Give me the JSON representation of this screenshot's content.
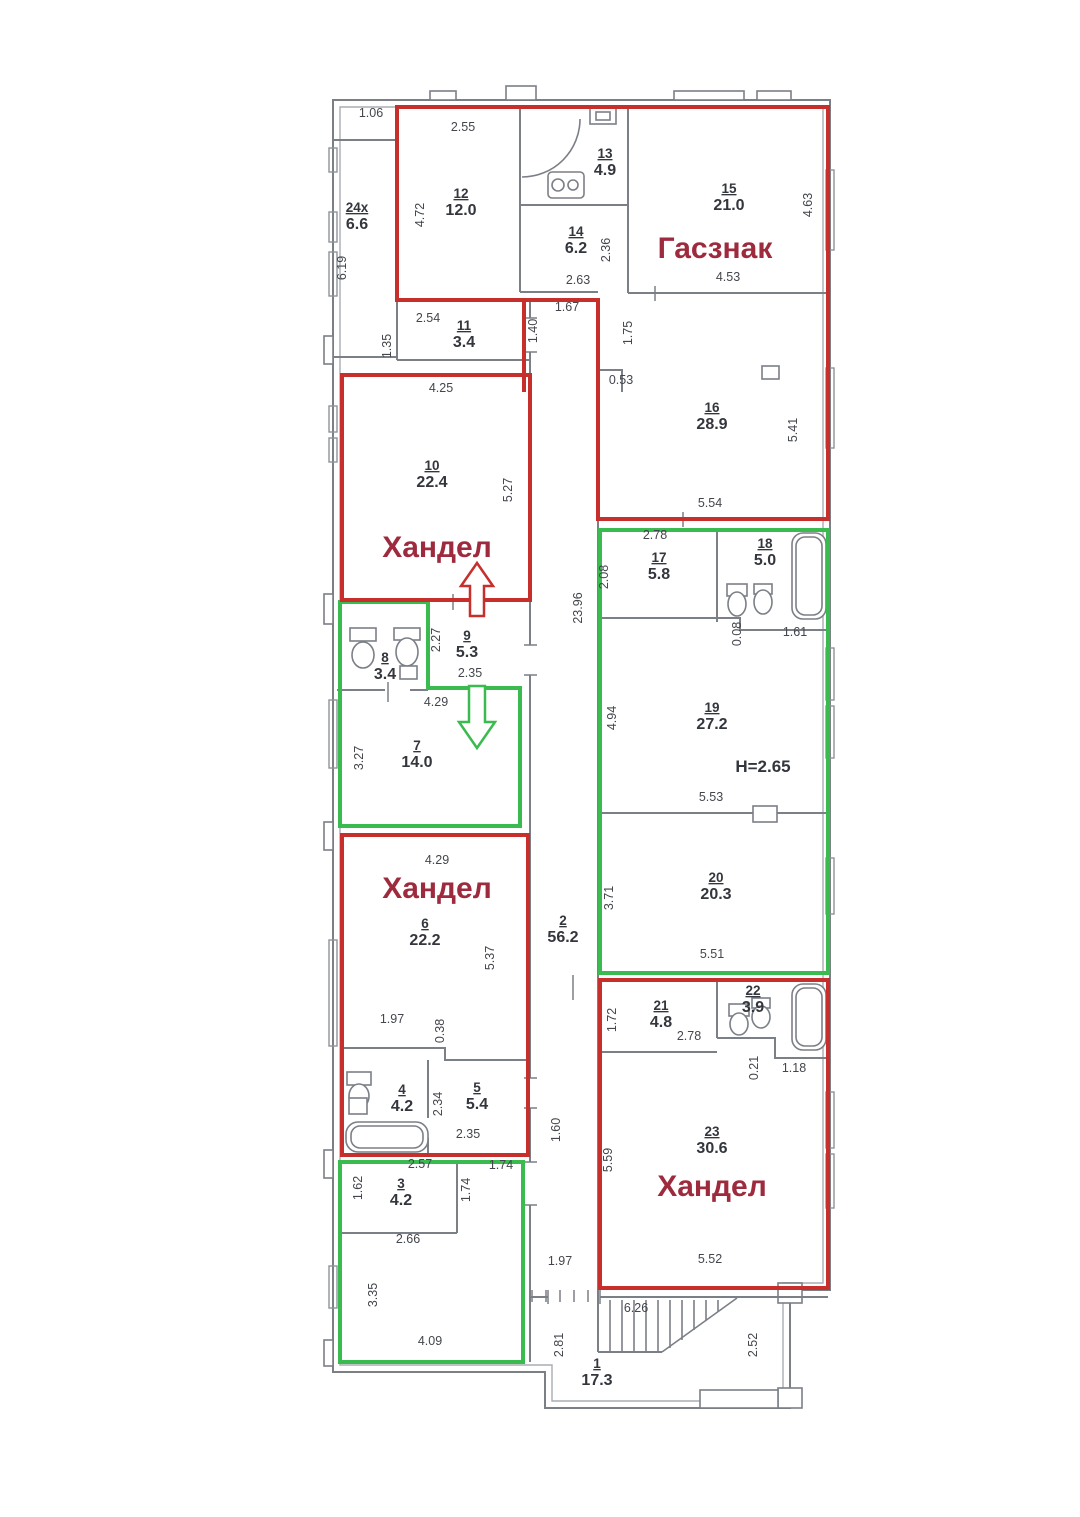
{
  "plan": {
    "colors": {
      "red_outline": "#c72f2c",
      "green_outline": "#3abb4f",
      "unit_label_red": "#9e2a3e",
      "wall_gray": "#7b7f86",
      "dim_text": "#43464c"
    },
    "unit_labels": [
      {
        "text": "Гасзнак",
        "x": 715,
        "y": 258
      },
      {
        "text": "Хандел",
        "x": 437,
        "y": 557
      },
      {
        "text": "Хандел",
        "x": 437,
        "y": 898
      },
      {
        "text": "Хандел",
        "x": 712,
        "y": 1196
      }
    ],
    "rooms": [
      {
        "num": "1",
        "area": "17.3",
        "x": 597,
        "y": 1368
      },
      {
        "num": "2",
        "area": "56.2",
        "x": 563,
        "y": 925
      },
      {
        "num": "3",
        "area": "4.2",
        "x": 401,
        "y": 1188
      },
      {
        "num": "4",
        "area": "4.2",
        "x": 402,
        "y": 1094
      },
      {
        "num": "5",
        "area": "5.4",
        "x": 477,
        "y": 1092
      },
      {
        "num": "6",
        "area": "22.2",
        "x": 425,
        "y": 928
      },
      {
        "num": "7",
        "area": "14.0",
        "x": 417,
        "y": 750
      },
      {
        "num": "8",
        "area": "3.4",
        "x": 385,
        "y": 662
      },
      {
        "num": "9",
        "area": "5.3",
        "x": 467,
        "y": 640
      },
      {
        "num": "10",
        "area": "22.4",
        "x": 432,
        "y": 470
      },
      {
        "num": "11",
        "area": "3.4",
        "x": 464,
        "y": 330
      },
      {
        "num": "12",
        "area": "12.0",
        "x": 461,
        "y": 198
      },
      {
        "num": "13",
        "area": "4.9",
        "x": 605,
        "y": 158
      },
      {
        "num": "14",
        "area": "6.2",
        "x": 576,
        "y": 236
      },
      {
        "num": "15",
        "area": "21.0",
        "x": 729,
        "y": 193
      },
      {
        "num": "16",
        "area": "28.9",
        "x": 712,
        "y": 412
      },
      {
        "num": "17",
        "area": "5.8",
        "x": 659,
        "y": 562
      },
      {
        "num": "18",
        "area": "5.0",
        "x": 765,
        "y": 548
      },
      {
        "num": "19",
        "area": "27.2",
        "x": 712,
        "y": 712
      },
      {
        "num": "20",
        "area": "20.3",
        "x": 716,
        "y": 882
      },
      {
        "num": "21",
        "area": "4.8",
        "x": 661,
        "y": 1010
      },
      {
        "num": "22",
        "area": "3.9",
        "x": 753,
        "y": 995
      },
      {
        "num": "23",
        "area": "30.6",
        "x": 712,
        "y": 1136
      },
      {
        "num": "24x",
        "area": "6.6",
        "x": 357,
        "y": 212
      }
    ],
    "dims": [
      {
        "t": "1.06",
        "x": 371,
        "y": 117,
        "r": 0
      },
      {
        "t": "6.19",
        "x": 346,
        "y": 268,
        "r": -90
      },
      {
        "t": "2.55",
        "x": 463,
        "y": 131,
        "r": 0
      },
      {
        "t": "4.72",
        "x": 424,
        "y": 215,
        "r": -90
      },
      {
        "t": "2.54",
        "x": 428,
        "y": 322,
        "r": 0
      },
      {
        "t": "1.35",
        "x": 391,
        "y": 346,
        "r": -90
      },
      {
        "t": "1.40",
        "x": 537,
        "y": 331,
        "r": -90
      },
      {
        "t": "1.67",
        "x": 567,
        "y": 311,
        "r": 0
      },
      {
        "t": "2.63",
        "x": 578,
        "y": 284,
        "r": 0
      },
      {
        "t": "1.75",
        "x": 632,
        "y": 333,
        "r": -90
      },
      {
        "t": "0.53",
        "x": 621,
        "y": 384,
        "r": 0
      },
      {
        "t": "2.36",
        "x": 610,
        "y": 250,
        "r": -90
      },
      {
        "t": "4.63",
        "x": 812,
        "y": 205,
        "r": -90
      },
      {
        "t": "4.53",
        "x": 728,
        "y": 281,
        "r": 0
      },
      {
        "t": "5.41",
        "x": 797,
        "y": 430,
        "r": -90
      },
      {
        "t": "5.54",
        "x": 710,
        "y": 507,
        "r": 0
      },
      {
        "t": "4.25",
        "x": 441,
        "y": 392,
        "r": 0
      },
      {
        "t": "5.27",
        "x": 512,
        "y": 490,
        "r": -90
      },
      {
        "t": "2.78",
        "x": 655,
        "y": 539,
        "r": 0
      },
      {
        "t": "2.08",
        "x": 608,
        "y": 577,
        "r": -90
      },
      {
        "t": "0.08",
        "x": 741,
        "y": 634,
        "r": -90
      },
      {
        "t": "1.61",
        "x": 795,
        "y": 636,
        "r": 0
      },
      {
        "t": "23.96",
        "x": 582,
        "y": 608,
        "r": -90
      },
      {
        "t": "2.27",
        "x": 440,
        "y": 640,
        "r": -90
      },
      {
        "t": "2.35",
        "x": 470,
        "y": 677,
        "r": 0
      },
      {
        "t": "4.29",
        "x": 436,
        "y": 706,
        "r": 0
      },
      {
        "t": "3.27",
        "x": 363,
        "y": 758,
        "r": -90
      },
      {
        "t": "4.94",
        "x": 616,
        "y": 718,
        "r": -90
      },
      {
        "t": "5.53",
        "x": 711,
        "y": 801,
        "r": 0
      },
      {
        "t": "3.71",
        "x": 613,
        "y": 898,
        "r": -90
      },
      {
        "t": "5.51",
        "x": 712,
        "y": 958,
        "r": 0
      },
      {
        "t": "4.29",
        "x": 437,
        "y": 864,
        "r": 0
      },
      {
        "t": "5.37",
        "x": 494,
        "y": 958,
        "r": -90
      },
      {
        "t": "1.97",
        "x": 392,
        "y": 1023,
        "r": 0
      },
      {
        "t": "0.38",
        "x": 444,
        "y": 1031,
        "r": -90
      },
      {
        "t": "2.34",
        "x": 442,
        "y": 1104,
        "r": -90
      },
      {
        "t": "2.35",
        "x": 468,
        "y": 1138,
        "r": 0
      },
      {
        "t": "1.72",
        "x": 616,
        "y": 1020,
        "r": -90
      },
      {
        "t": "2.78",
        "x": 689,
        "y": 1040,
        "r": 0
      },
      {
        "t": "0.21",
        "x": 758,
        "y": 1068,
        "r": -90
      },
      {
        "t": "1.18",
        "x": 794,
        "y": 1072,
        "r": 0
      },
      {
        "t": "5.59",
        "x": 612,
        "y": 1160,
        "r": -90
      },
      {
        "t": "5.52",
        "x": 710,
        "y": 1263,
        "r": 0
      },
      {
        "t": "2.57",
        "x": 420,
        "y": 1168,
        "r": 0
      },
      {
        "t": "1.62",
        "x": 362,
        "y": 1188,
        "r": -90
      },
      {
        "t": "1.74",
        "x": 470,
        "y": 1190,
        "r": -90
      },
      {
        "t": "1.74",
        "x": 501,
        "y": 1169,
        "r": 0
      },
      {
        "t": "2.66",
        "x": 408,
        "y": 1243,
        "r": 0
      },
      {
        "t": "3.35",
        "x": 377,
        "y": 1295,
        "r": -90
      },
      {
        "t": "4.09",
        "x": 430,
        "y": 1345,
        "r": 0
      },
      {
        "t": "1.60",
        "x": 560,
        "y": 1130,
        "r": -90
      },
      {
        "t": "1.97",
        "x": 560,
        "y": 1265,
        "r": 0
      },
      {
        "t": "6.26",
        "x": 636,
        "y": 1312,
        "r": 0
      },
      {
        "t": "2.81",
        "x": 563,
        "y": 1345,
        "r": -90
      },
      {
        "t": "2.52",
        "x": 757,
        "y": 1345,
        "r": -90
      }
    ],
    "annotations": [
      {
        "text": "H=2.65",
        "x": 763,
        "y": 772
      }
    ]
  }
}
